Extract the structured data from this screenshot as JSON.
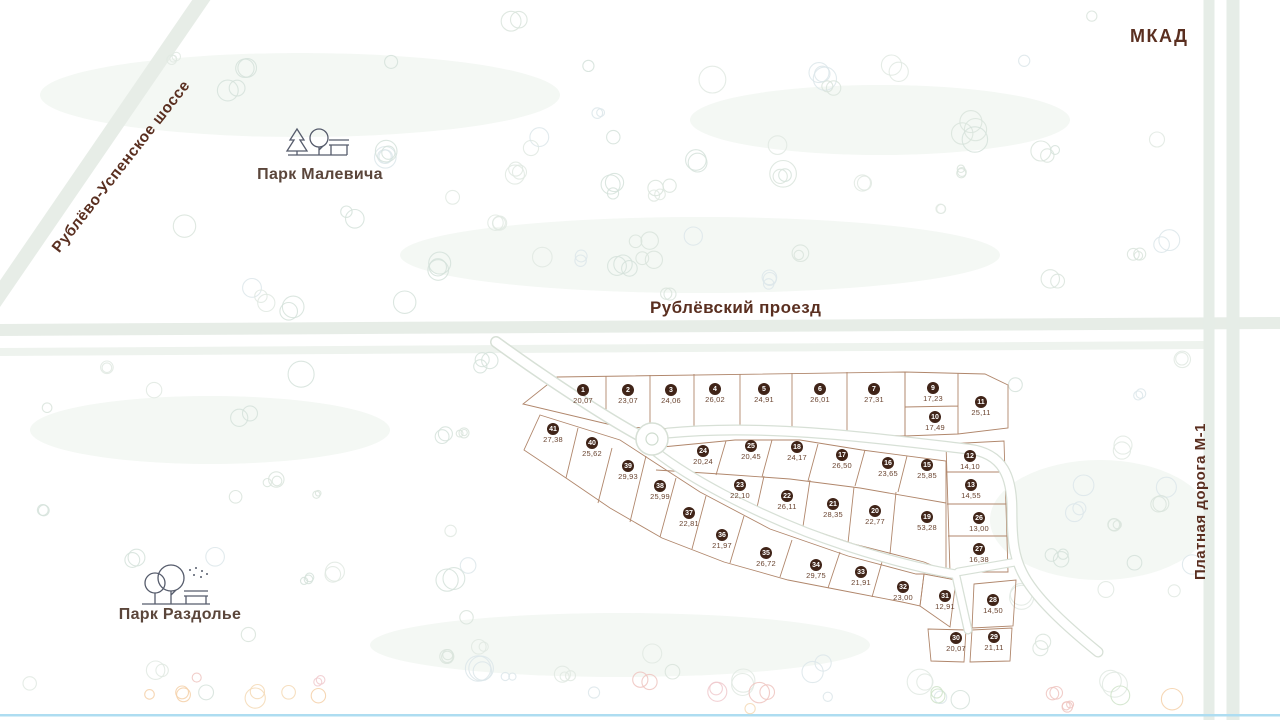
{
  "labels": {
    "mkad": "МКАД",
    "toll_road": "Платная дорога  М-1",
    "highway": "Рублёво-Успенское шоссе",
    "proezd": "Рублёвский проезд",
    "park_malevicha": "Парк Малевича",
    "park_razdolye": "Парк Раздолье"
  },
  "colors": {
    "badge": "#402418",
    "badge_text": "#ffffff",
    "plot_boundary": "#a87a5c",
    "road_label": "#5a2f20",
    "park_label": "#5b463b",
    "road_fill": "#e8eee8",
    "internal_road_edge": "#d7e0d6",
    "bottom_water_line": "#aeddf1"
  },
  "plots": [
    {
      "num": "1",
      "area": "20,07",
      "x": 583,
      "y": 391
    },
    {
      "num": "2",
      "area": "23,07",
      "x": 628,
      "y": 391
    },
    {
      "num": "3",
      "area": "24,06",
      "x": 671,
      "y": 391
    },
    {
      "num": "4",
      "area": "26,02",
      "x": 715,
      "y": 390
    },
    {
      "num": "5",
      "area": "24,91",
      "x": 764,
      "y": 390
    },
    {
      "num": "6",
      "area": "26,01",
      "x": 820,
      "y": 390
    },
    {
      "num": "7",
      "area": "27,31",
      "x": 874,
      "y": 390
    },
    {
      "num": "9",
      "area": "17,23",
      "x": 933,
      "y": 389
    },
    {
      "num": "10",
      "area": "17,49",
      "x": 935,
      "y": 418
    },
    {
      "num": "11",
      "area": "25,11",
      "x": 981,
      "y": 403
    },
    {
      "num": "12",
      "area": "14,10",
      "x": 970,
      "y": 457
    },
    {
      "num": "13",
      "area": "14,55",
      "x": 971,
      "y": 486
    },
    {
      "num": "15",
      "area": "25,85",
      "x": 927,
      "y": 466
    },
    {
      "num": "16",
      "area": "23,65",
      "x": 888,
      "y": 464
    },
    {
      "num": "17",
      "area": "26,50",
      "x": 842,
      "y": 456
    },
    {
      "num": "18",
      "area": "24,17",
      "x": 797,
      "y": 448
    },
    {
      "num": "19",
      "area": "53,28",
      "x": 927,
      "y": 518
    },
    {
      "num": "20",
      "area": "22,77",
      "x": 875,
      "y": 512
    },
    {
      "num": "21",
      "area": "28,35",
      "x": 833,
      "y": 505
    },
    {
      "num": "22",
      "area": "26,11",
      "x": 787,
      "y": 497
    },
    {
      "num": "23",
      "area": "22,10",
      "x": 740,
      "y": 486
    },
    {
      "num": "24",
      "area": "20,24",
      "x": 703,
      "y": 452
    },
    {
      "num": "25",
      "area": "20,45",
      "x": 751,
      "y": 447
    },
    {
      "num": "26",
      "area": "13,00",
      "x": 979,
      "y": 519
    },
    {
      "num": "27",
      "area": "16,38",
      "x": 979,
      "y": 550
    },
    {
      "num": "28",
      "area": "14,50",
      "x": 993,
      "y": 601
    },
    {
      "num": "29",
      "area": "21,11",
      "x": 994,
      "y": 638
    },
    {
      "num": "30",
      "area": "20,07",
      "x": 956,
      "y": 639
    },
    {
      "num": "31",
      "area": "12,91",
      "x": 945,
      "y": 597
    },
    {
      "num": "32",
      "area": "23,00",
      "x": 903,
      "y": 588
    },
    {
      "num": "33",
      "area": "21,91",
      "x": 861,
      "y": 573
    },
    {
      "num": "34",
      "area": "29,75",
      "x": 816,
      "y": 566
    },
    {
      "num": "35",
      "area": "26,72",
      "x": 766,
      "y": 554
    },
    {
      "num": "36",
      "area": "21,97",
      "x": 722,
      "y": 536
    },
    {
      "num": "37",
      "area": "22,81",
      "x": 689,
      "y": 514
    },
    {
      "num": "38",
      "area": "25,99",
      "x": 660,
      "y": 487
    },
    {
      "num": "39",
      "area": "29,93",
      "x": 628,
      "y": 467
    },
    {
      "num": "40",
      "area": "25,62",
      "x": 592,
      "y": 444
    },
    {
      "num": "41",
      "area": "27,38",
      "x": 553,
      "y": 430
    }
  ]
}
